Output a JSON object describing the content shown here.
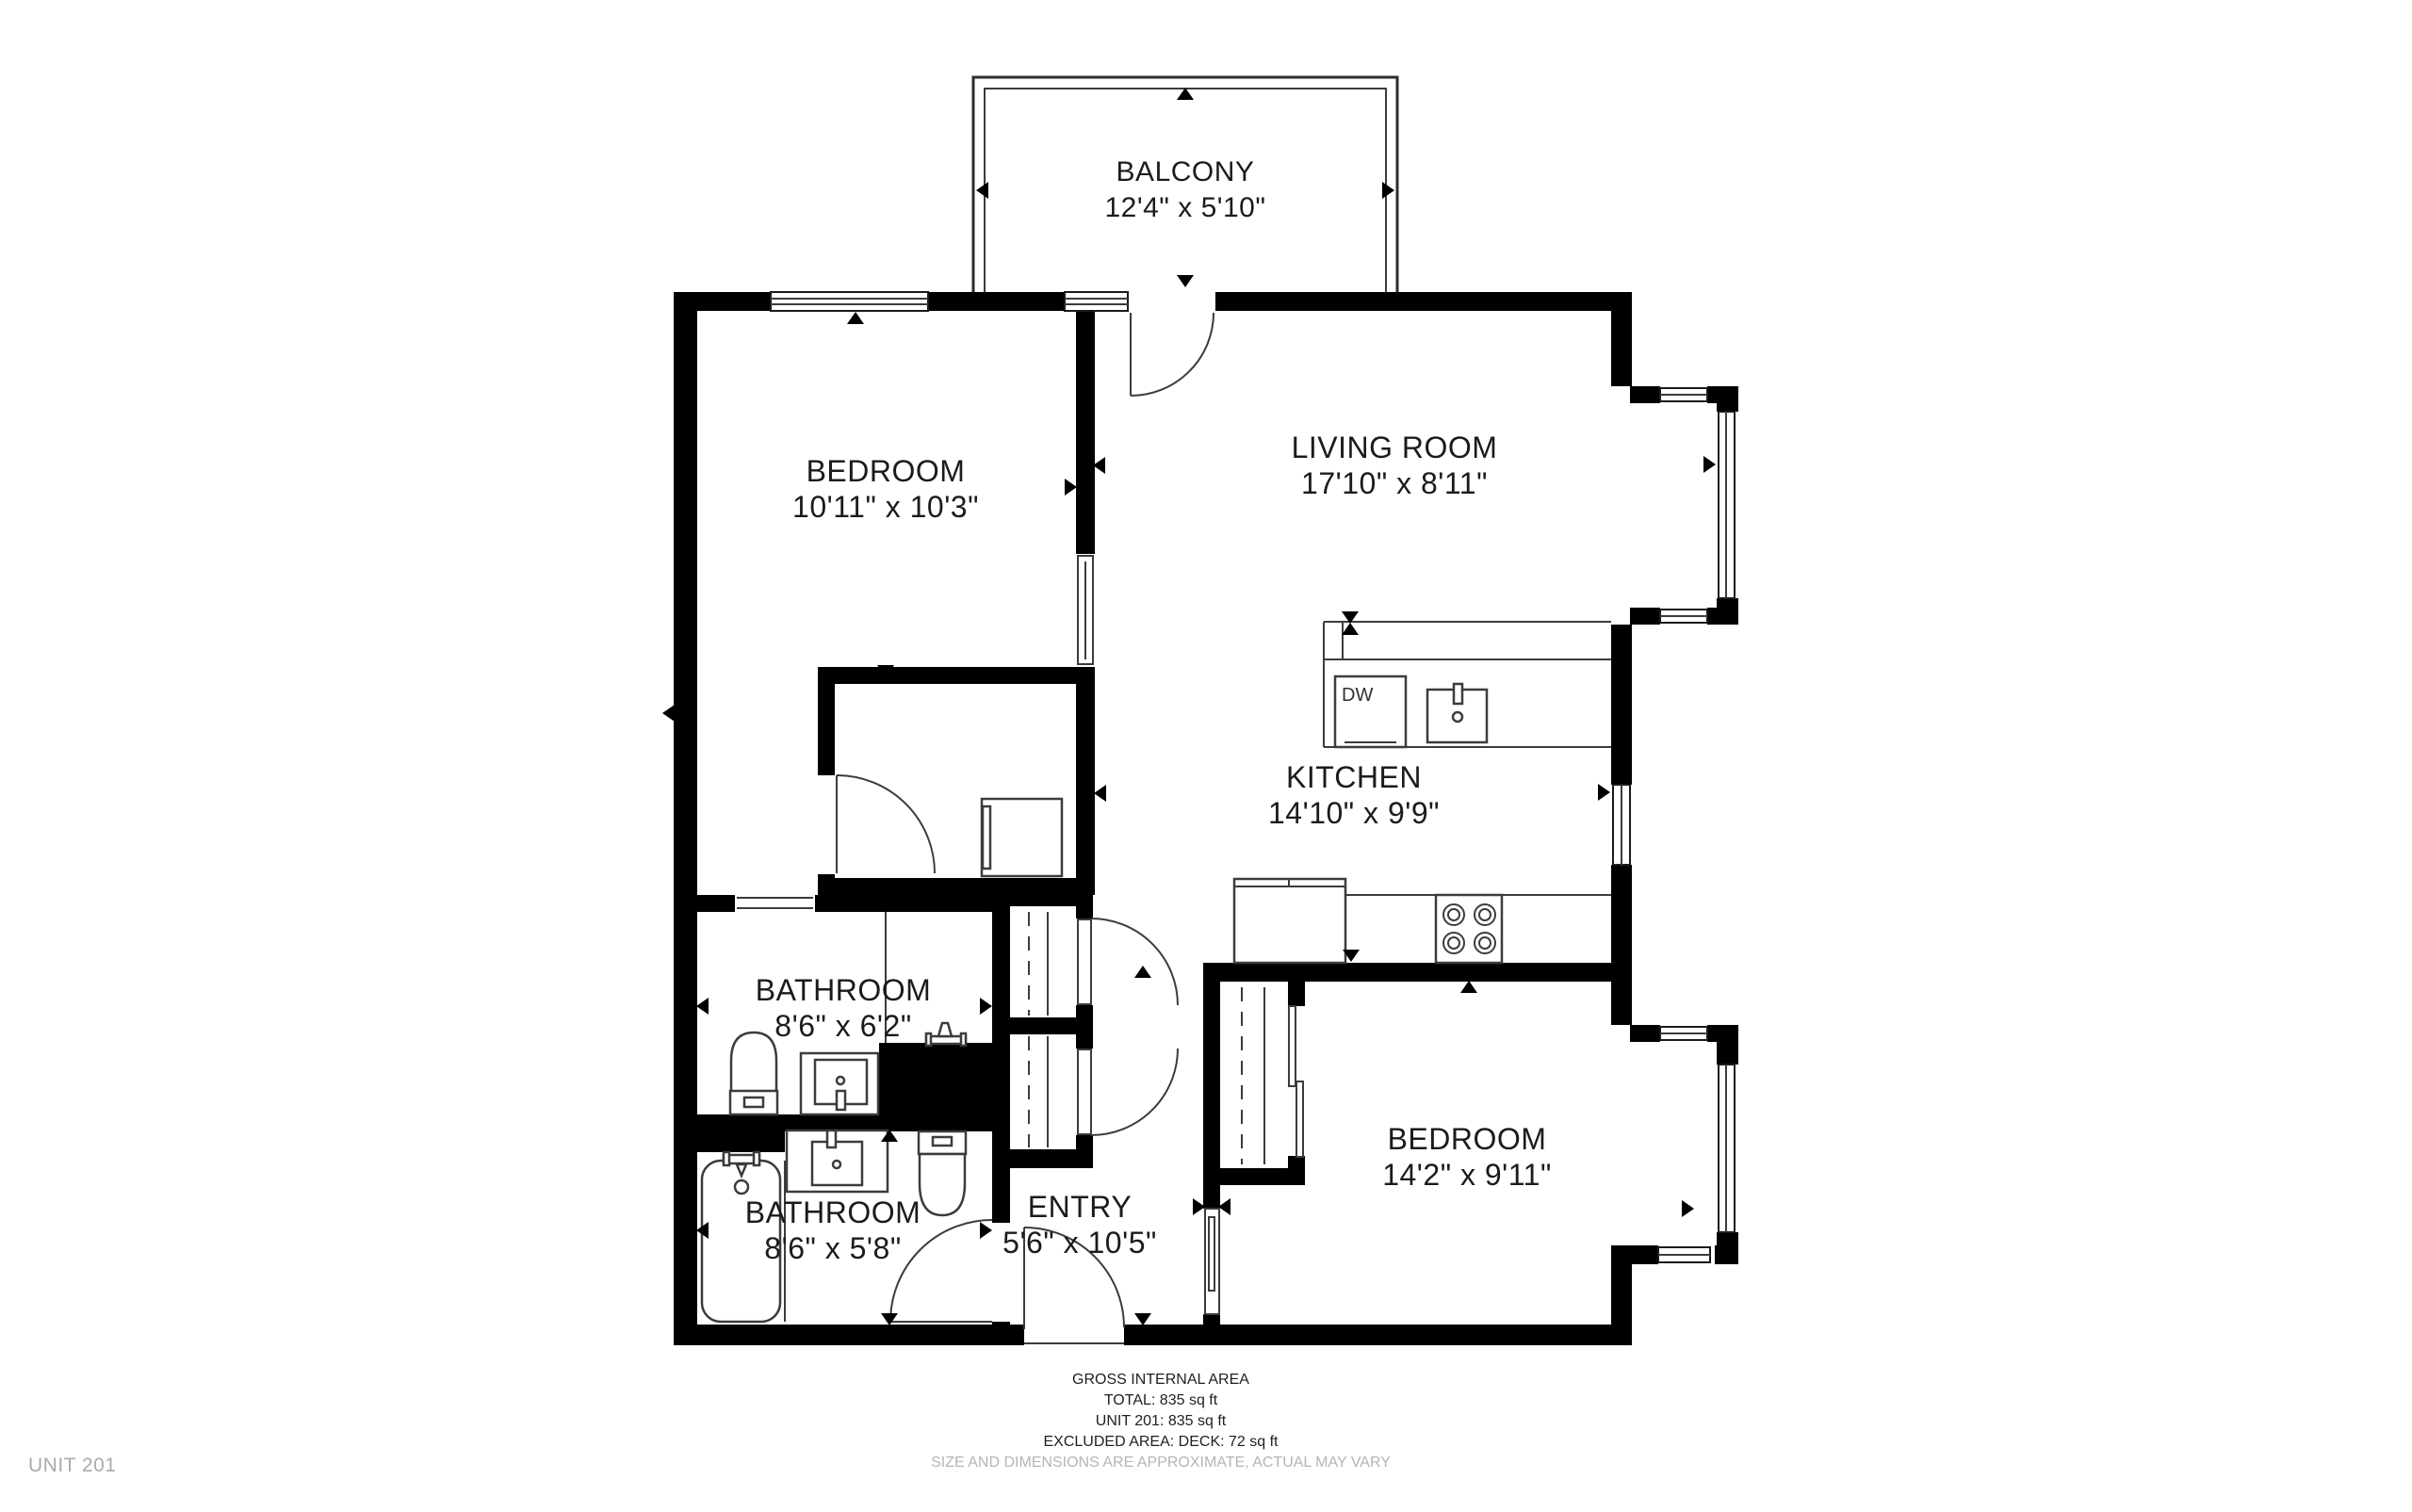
{
  "unit_label": "UNIT 201",
  "rooms": {
    "balcony": {
      "name": "BALCONY",
      "dims": "12'4\" x 5'10\""
    },
    "bedroom1": {
      "name": "BEDROOM",
      "dims": "10'11\" x 10'3\""
    },
    "living_room": {
      "name": "LIVING ROOM",
      "dims": "17'10\" x 8'11\""
    },
    "kitchen": {
      "name": "KITCHEN",
      "dims": "14'10\" x 9'9\""
    },
    "bathroom1": {
      "name": "BATHROOM",
      "dims": "8'6\" x 6'2\""
    },
    "bathroom2": {
      "name": "BATHROOM",
      "dims": "8'6\" x 5'8\""
    },
    "entry": {
      "name": "ENTRY",
      "dims": "5'6\" x 10'5\""
    },
    "bedroom2": {
      "name": "BEDROOM",
      "dims": "14'2\" x 9'11\""
    }
  },
  "appliances": {
    "dishwasher": "DW"
  },
  "footer": {
    "title": "GROSS INTERNAL AREA",
    "total": "TOTAL: 835 sq ft",
    "unit": "UNIT 201: 835 sq ft",
    "excluded": "EXCLUDED AREA: DECK: 72 sq ft",
    "disclaimer": "SIZE AND DIMENSIONS ARE APPROXIMATE, ACTUAL MAY VARY"
  },
  "colors": {
    "wall": "#000000",
    "fixture_line": "#3c3c3c",
    "label_text": "#1b1b1b",
    "muted_text": "#b5b5b5"
  }
}
